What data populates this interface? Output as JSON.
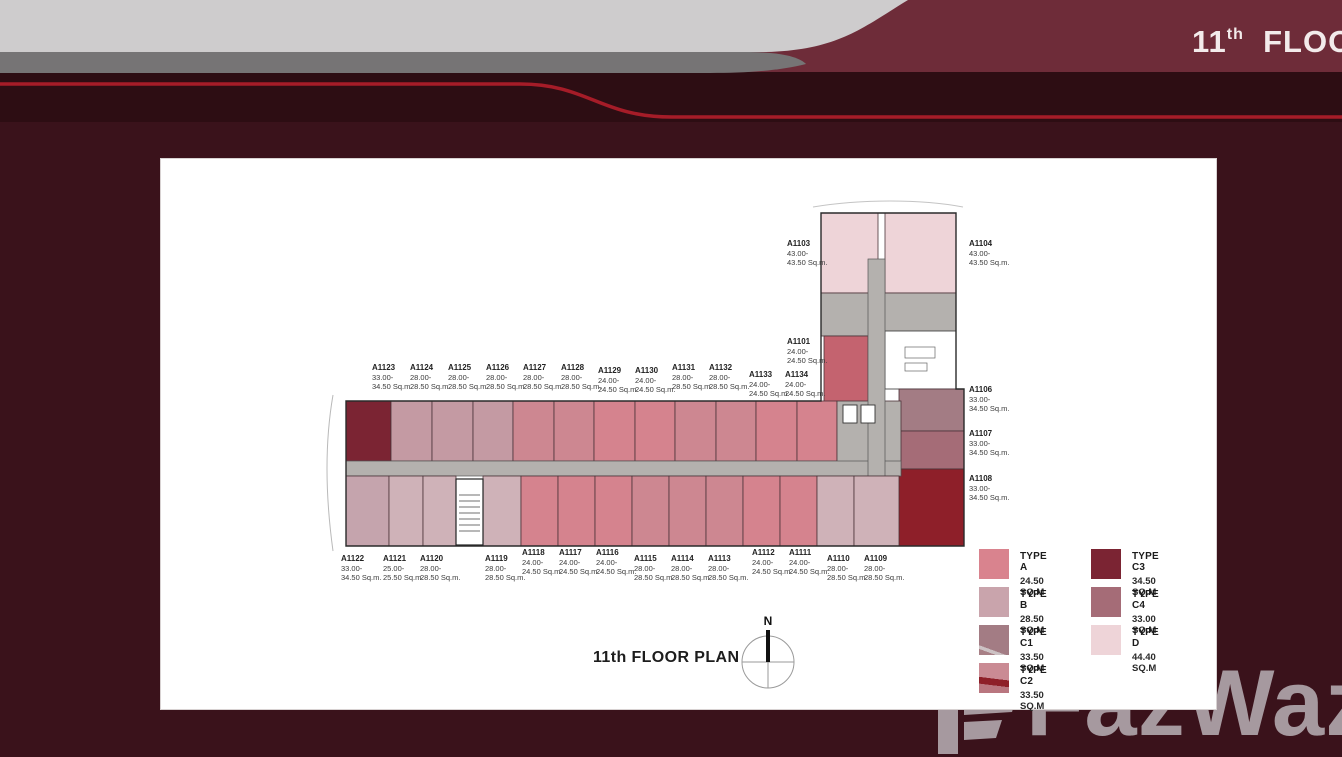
{
  "header": {
    "floor_number": "11",
    "floor_suffix": "th",
    "floor_word": "FLOO"
  },
  "watermark": {
    "text": "FazWaz"
  },
  "plan": {
    "title": "11th FLOOR PLAN",
    "north_label": "N",
    "units": [
      {
        "id": "A1123",
        "area1": "33.00-",
        "area2": "34.50 Sq.m.",
        "x": 211,
        "y": 204
      },
      {
        "id": "A1124",
        "area1": "28.00-",
        "area2": "28.50 Sq.m.",
        "x": 249,
        "y": 204
      },
      {
        "id": "A1125",
        "area1": "28.00-",
        "area2": "28.50 Sq.m.",
        "x": 287,
        "y": 204
      },
      {
        "id": "A1126",
        "area1": "28.00-",
        "area2": "28.50 Sq.m.",
        "x": 325,
        "y": 204
      },
      {
        "id": "A1127",
        "area1": "28.00-",
        "area2": "28.50 Sq.m.",
        "x": 362,
        "y": 204
      },
      {
        "id": "A1128",
        "area1": "28.00-",
        "area2": "28.50 Sq.m.",
        "x": 400,
        "y": 204
      },
      {
        "id": "A1129",
        "area1": "24.00-",
        "area2": "24.50 Sq.m.",
        "x": 437,
        "y": 207
      },
      {
        "id": "A1130",
        "area1": "24.00-",
        "area2": "24.50 Sq.m.",
        "x": 474,
        "y": 207
      },
      {
        "id": "A1131",
        "area1": "28.00-",
        "area2": "28.50 Sq.m.",
        "x": 511,
        "y": 204
      },
      {
        "id": "A1132",
        "area1": "28.00-",
        "area2": "28.50 Sq.m.",
        "x": 548,
        "y": 204
      },
      {
        "id": "A1133",
        "area1": "24.00-",
        "area2": "24.50 Sq.m.",
        "x": 588,
        "y": 211
      },
      {
        "id": "A1134",
        "area1": "24.00-",
        "area2": "24.50 Sq.m.",
        "x": 624,
        "y": 211
      },
      {
        "id": "A1101",
        "area1": "24.00-",
        "area2": "24.50 Sq.m.",
        "x": 626,
        "y": 178
      },
      {
        "id": "A1103",
        "area1": "43.00-",
        "area2": "43.50 Sq.m.",
        "x": 626,
        "y": 80
      },
      {
        "id": "A1104",
        "area1": "43.00-",
        "area2": "43.50 Sq.m.",
        "x": 808,
        "y": 80
      },
      {
        "id": "A1106",
        "area1": "33.00-",
        "area2": "34.50 Sq.m.",
        "x": 808,
        "y": 226
      },
      {
        "id": "A1107",
        "area1": "33.00-",
        "area2": "34.50 Sq.m.",
        "x": 808,
        "y": 270
      },
      {
        "id": "A1108",
        "area1": "33.00-",
        "area2": "34.50 Sq.m.",
        "x": 808,
        "y": 315
      },
      {
        "id": "A1122",
        "area1": "33.00-",
        "area2": "34.50 Sq.m.",
        "x": 180,
        "y": 395
      },
      {
        "id": "A1121",
        "area1": "25.00-",
        "area2": "25.50 Sq.m.",
        "x": 222,
        "y": 395
      },
      {
        "id": "A1120",
        "area1": "28.00-",
        "area2": "28.50 Sq.m.",
        "x": 259,
        "y": 395
      },
      {
        "id": "A1119",
        "area1": "28.00-",
        "area2": "28.50 Sq.m.",
        "x": 324,
        "y": 395
      },
      {
        "id": "A1118",
        "area1": "24.00-",
        "area2": "24.50 Sq.m.",
        "x": 361,
        "y": 389
      },
      {
        "id": "A1117",
        "area1": "24.00-",
        "area2": "24.50 Sq.m.",
        "x": 398,
        "y": 389
      },
      {
        "id": "A1116",
        "area1": "24.00-",
        "area2": "24.50 Sq.m.",
        "x": 435,
        "y": 389
      },
      {
        "id": "A1115",
        "area1": "28.00-",
        "area2": "28.50 Sq.m.",
        "x": 473,
        "y": 395
      },
      {
        "id": "A1114",
        "area1": "28.00-",
        "area2": "28.50 Sq.m.",
        "x": 510,
        "y": 395
      },
      {
        "id": "A1113",
        "area1": "28.00-",
        "area2": "28.50 Sq.m.",
        "x": 547,
        "y": 395
      },
      {
        "id": "A1112",
        "area1": "24.00-",
        "area2": "24.50 Sq.m.",
        "x": 591,
        "y": 389
      },
      {
        "id": "A1111",
        "area1": "24.00-",
        "area2": "24.50 Sq.m.",
        "x": 628,
        "y": 389
      },
      {
        "id": "A1110",
        "area1": "28.00-",
        "area2": "28.50 Sq.m.",
        "x": 666,
        "y": 395
      },
      {
        "id": "A1109",
        "area1": "28.00-",
        "area2": "28.50 Sq.m.",
        "x": 703,
        "y": 395
      }
    ]
  },
  "legend": {
    "columns": [
      [
        {
          "label": "TYPE A",
          "area": "24.50 SQ.M",
          "color": "#d9838e"
        },
        {
          "label": "TYPE B",
          "area": "28.50 SQ.M",
          "color": "#c9a4ac"
        },
        {
          "label": "TYPE C1",
          "area": "33.50 SQ.M",
          "color": "#a37c84",
          "accent": "#cdc2c4"
        },
        {
          "label": "TYPE C2",
          "area": "33.50 SQ.M",
          "color": "#ca8b94",
          "stripe": "#8e1f28"
        }
      ],
      [
        {
          "label": "TYPE C3",
          "area": "34.50 SQ.M",
          "color": "#7b2433"
        },
        {
          "label": "TYPE C4",
          "area": "33.00 SQ.M",
          "color": "#a56c77"
        },
        {
          "label": "TYPE D",
          "area": "44.40 SQ.M",
          "color": "#eed4d8"
        }
      ]
    ]
  },
  "colors": {
    "page_background": "#3a121b",
    "header_band": "#6e2c39",
    "header_dark_strip": "#2d0d13",
    "red_line": "#a51c28",
    "light_gray_band": "#cecccd",
    "mid_gray_band": "#767475",
    "corridor_gray": "#b4b1ae",
    "dark_red_unit": "#8e1f29",
    "rose_unit": "#c4636f"
  }
}
